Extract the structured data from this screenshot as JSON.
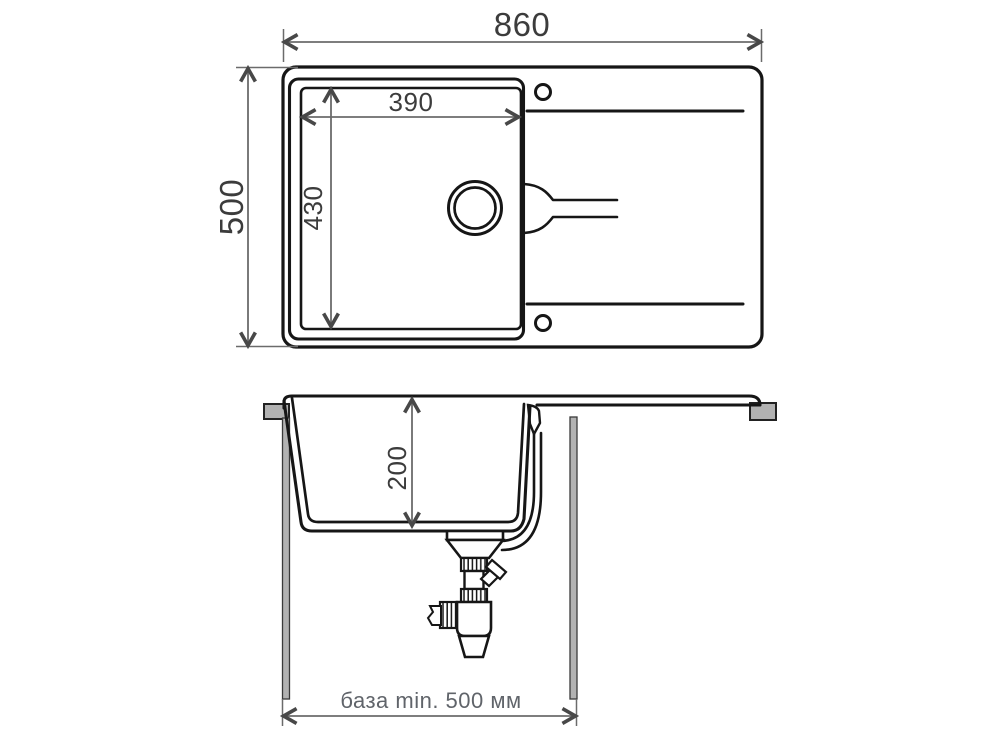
{
  "drawing": {
    "top_view": {
      "overall_width_label": "860",
      "overall_depth_label": "500",
      "bowl_width_label": "390",
      "bowl_length_label": "430"
    },
    "section_view": {
      "bowl_depth_label": "200",
      "cabinet_base_label": "база min. 500 мм"
    },
    "colors": {
      "background": "#ffffff",
      "line": "#161616",
      "dimension_line": "#6b6b6b",
      "dimension_arrow": "#484848",
      "dimension_text": "#3c3c3c",
      "label_text": "#60646a",
      "hardware_gray": "#b2b2b2"
    }
  }
}
